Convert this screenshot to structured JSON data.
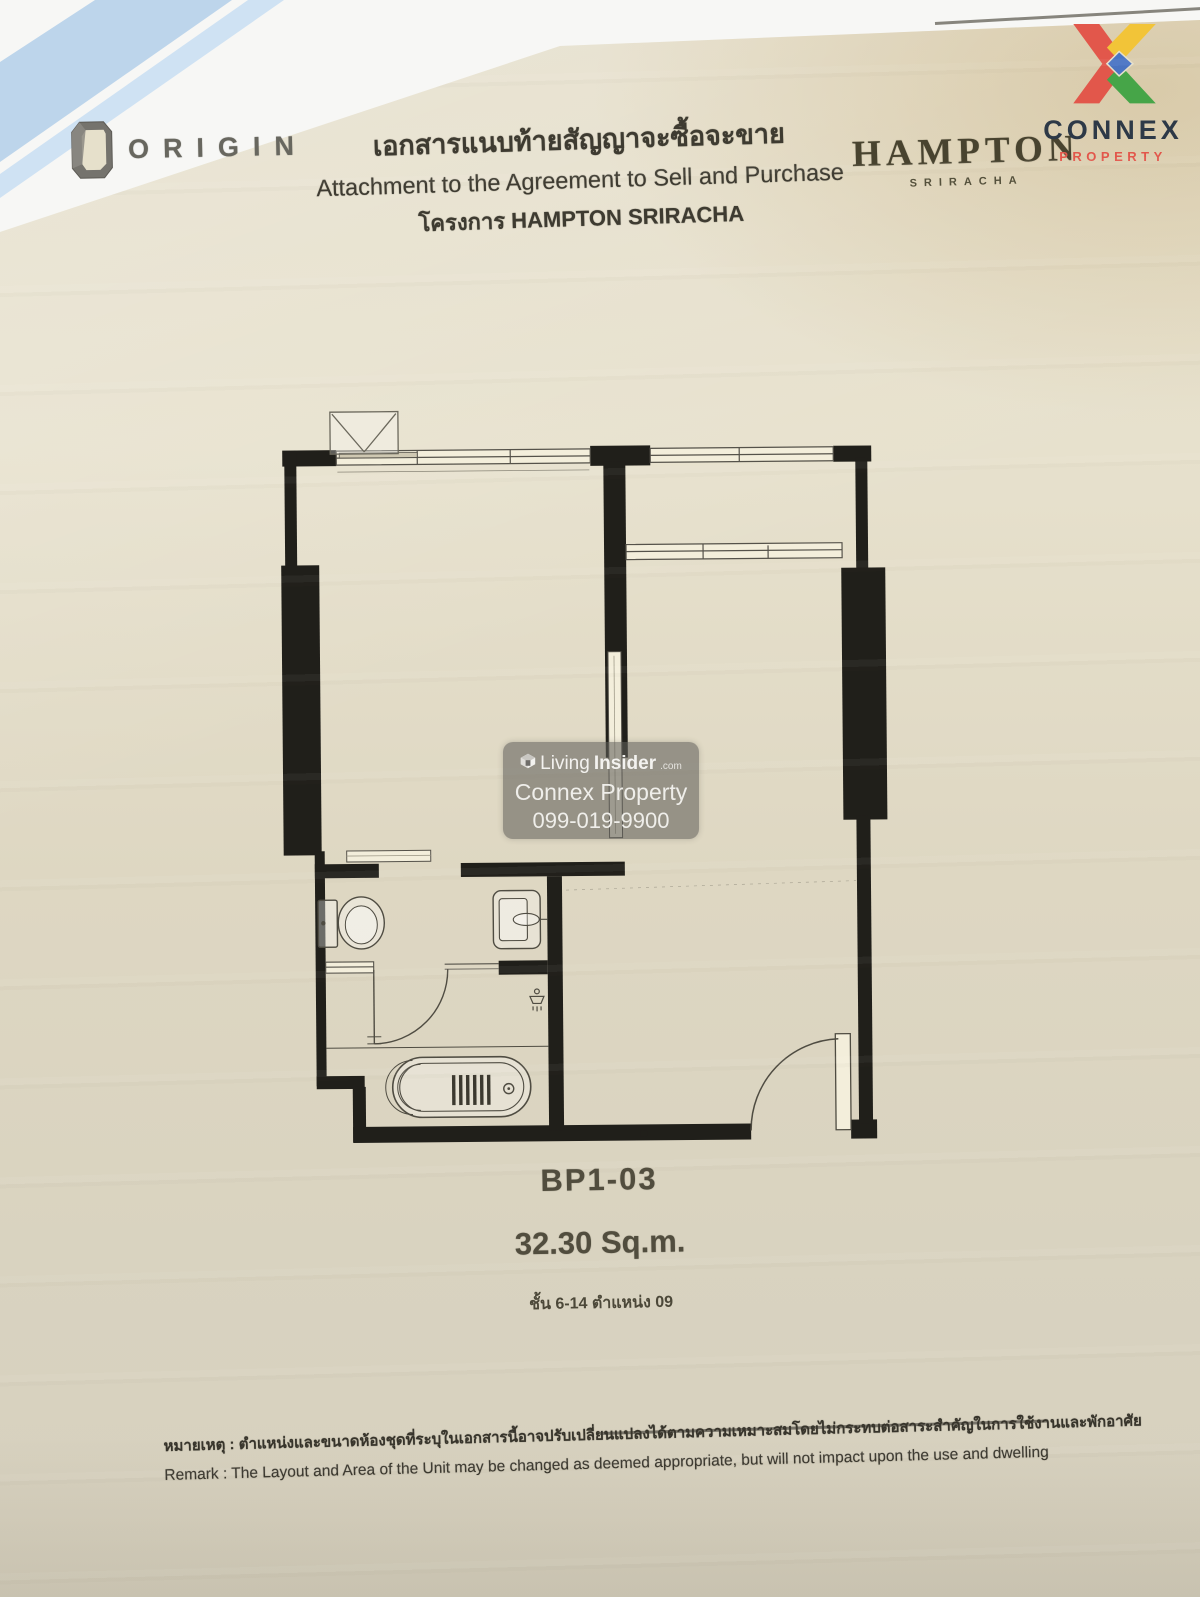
{
  "header": {
    "origin": {
      "brand": "ORIGIN"
    },
    "doc_title_thai": "เอกสารแนบท้ายสัญญาจะซื้อจะขาย",
    "doc_title_en": "Attachment to the Agreement to Sell and Purchase",
    "project_line": "โครงการ HAMPTON SRIRACHA",
    "hampton": {
      "brand": "HAMPTON",
      "sub_brand": "SRIRACHA"
    },
    "connex": {
      "brand": "CONNEX",
      "sub_brand": "PROPERTY"
    }
  },
  "watermark": {
    "brand_prefix": "Living",
    "brand_bold": "Insider",
    "brand_tld": ".com",
    "agent": "Connex Property",
    "phone": "099-019-9900"
  },
  "floorplan": {
    "unit_type": "BP1-03",
    "area": "32.30 Sq.m.",
    "floor_position_thai": "ชั้น 6-14 ตำแหน่ง 09",
    "rooms": [
      "bedroom",
      "living-dining",
      "bathroom",
      "balcony"
    ],
    "fixtures": [
      "toilet",
      "basin",
      "bathtub",
      "shower",
      "entry-door",
      "sliding-door",
      "ac-condenser"
    ]
  },
  "remark": {
    "thai": "หมายเหตุ : ตำแหน่งและขนาดห้องชุดที่ระบุในเอกสารนี้อาจปรับเปลี่ยนแปลงได้ตามความเหมาะสมโดยไม่กระทบต่อสาระสำคัญในการใช้งานและพักอาศัย",
    "en": "Remark   : The Layout and Area of the Unit may be changed as deemed appropriate, but will not impact upon the use and dwelling"
  },
  "colors": {
    "paper": "#e0d9c3",
    "wall_black": "#201f1a",
    "fixture_line": "#4f4c42",
    "connex_navy": "#2d3947",
    "connex_red": "#e2574b",
    "connex_yellow": "#f2c438",
    "connex_green": "#46a548",
    "connex_blue": "#4a74c4",
    "folder_blue": "#bdd5eb",
    "watermark_bg": "rgba(96,94,90,0.58)"
  }
}
